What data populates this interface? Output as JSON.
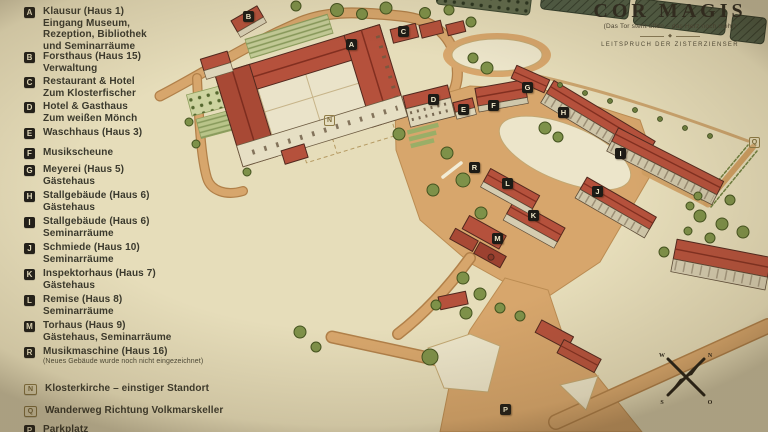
{
  "title": {
    "main": "COR MAGIS",
    "subtitle": "(Das Tor steht offen – das Herz noch mehr)",
    "tagline": "LEITSPRUCH DER ZISTERZIENSER",
    "ornament": "◆"
  },
  "legend": {
    "items": [
      {
        "letter": "A",
        "style": "solid",
        "lines": [
          "Klausur (Haus 1)",
          "Eingang Museum,",
          "Rezeption, Bibliothek",
          "und Seminarräume"
        ]
      },
      {
        "letter": "B",
        "style": "solid",
        "lines": [
          "Forsthaus (Haus 15)",
          "Verwaltung"
        ]
      },
      {
        "letter": "C",
        "style": "solid",
        "lines": [
          "Restaurant & Hotel",
          "Zum Klosterfischer"
        ]
      },
      {
        "letter": "D",
        "style": "solid",
        "lines": [
          "Hotel & Gasthaus",
          "Zum weißen Mönch"
        ]
      },
      {
        "letter": "E",
        "style": "solid",
        "lines": [
          "Waschhaus (Haus 3)"
        ]
      },
      {
        "letter": "F",
        "style": "solid",
        "lines": [
          "Musikscheune"
        ]
      },
      {
        "letter": "G",
        "style": "solid",
        "lines": [
          "Meyerei (Haus 5)",
          "Gästehaus"
        ]
      },
      {
        "letter": "H",
        "style": "solid",
        "lines": [
          "Stallgebäude (Haus 6)",
          "Gästehaus"
        ]
      },
      {
        "letter": "I",
        "style": "solid",
        "lines": [
          "Stallgebäude (Haus 6)",
          "Seminarräume"
        ]
      },
      {
        "letter": "J",
        "style": "solid",
        "lines": [
          "Schmiede (Haus 10)",
          "Seminarräume"
        ]
      },
      {
        "letter": "K",
        "style": "solid",
        "lines": [
          "Inspektorhaus (Haus 7)",
          "Gästehaus"
        ]
      },
      {
        "letter": "L",
        "style": "solid",
        "lines": [
          "Remise (Haus 8)",
          "Seminarräume"
        ]
      },
      {
        "letter": "M",
        "style": "solid",
        "lines": [
          "Torhaus (Haus 9)",
          "Gästehaus, Seminarräume"
        ]
      },
      {
        "letter": "R",
        "style": "solid",
        "lines": [
          "Musikmaschine (Haus 16)",
          "(Neues Gebäude wurde noch nicht eingezeichnet)"
        ]
      },
      {
        "letter": "N",
        "style": "outline",
        "lines": [
          "Klosterkirche – einstiger Standort"
        ]
      },
      {
        "letter": "Q",
        "style": "outline",
        "lines": [
          "Wanderweg Richtung Volkmarskeller"
        ]
      },
      {
        "letter": "P",
        "style": "solid",
        "lines": [
          "Parkplatz"
        ]
      }
    ]
  },
  "map": {
    "markers": [
      {
        "letter": "A",
        "style": "solid"
      },
      {
        "letter": "B",
        "style": "solid"
      },
      {
        "letter": "C",
        "style": "solid"
      },
      {
        "letter": "D",
        "style": "solid"
      },
      {
        "letter": "E",
        "style": "solid"
      },
      {
        "letter": "F",
        "style": "solid"
      },
      {
        "letter": "G",
        "style": "solid"
      },
      {
        "letter": "H",
        "style": "solid"
      },
      {
        "letter": "I",
        "style": "solid"
      },
      {
        "letter": "J",
        "style": "solid"
      },
      {
        "letter": "K",
        "style": "solid"
      },
      {
        "letter": "L",
        "style": "solid"
      },
      {
        "letter": "M",
        "style": "solid"
      },
      {
        "letter": "R",
        "style": "solid"
      },
      {
        "letter": "N",
        "style": "outline"
      },
      {
        "letter": "Q",
        "style": "outline"
      },
      {
        "letter": "P",
        "style": "solid"
      }
    ],
    "compass": {
      "n": "N",
      "e": "O",
      "s": "S",
      "w": "W"
    }
  }
}
